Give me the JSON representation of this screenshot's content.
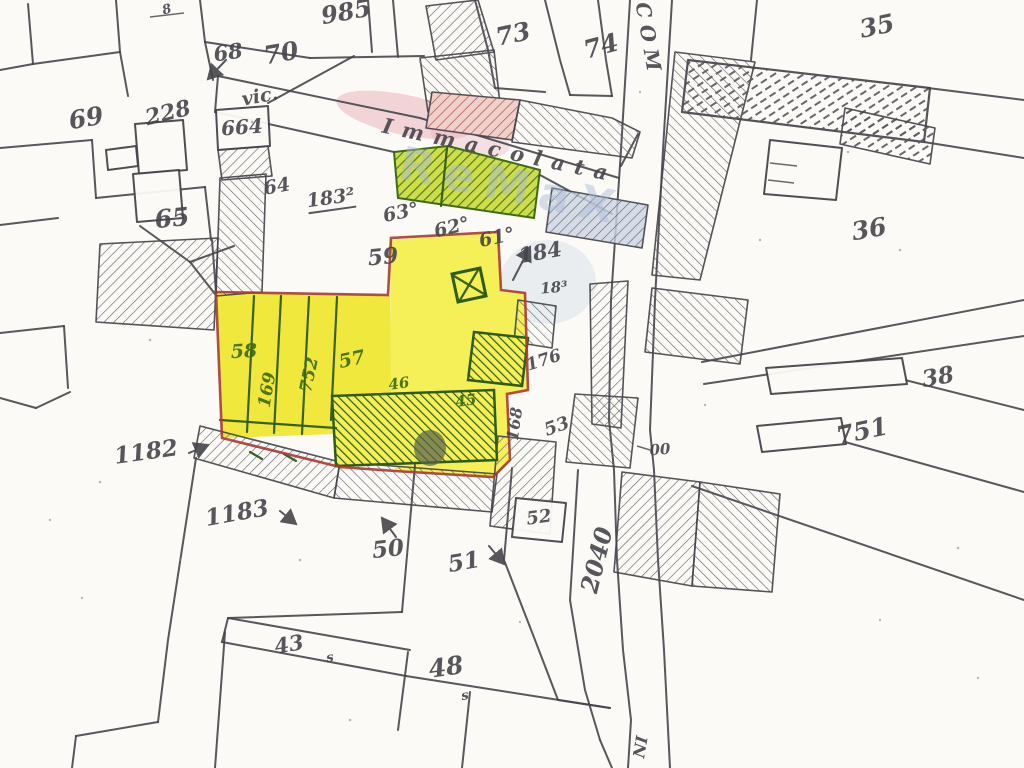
{
  "title": "Mappa catastale - vic. Immacolata",
  "colors": {
    "paper": "#fbfaf6",
    "pencil": "#45454b",
    "hatch": "#5b5b61",
    "yellow": "#f0e83c",
    "yellow_light": "#f5ef58",
    "red_outline": "#a83a36",
    "green_dark": "#2f5c17",
    "green_bright": "#4e7d1c",
    "green_bg": "#cedd49",
    "pink_bg": "#f0d0ca",
    "pink_line": "#b4625c",
    "blue_bg": "#ccd5e3",
    "label_green": "#3c6a12",
    "watermark_pink": "#e9aeb8",
    "watermark_blue": "#a9b9d8"
  },
  "watermark": {
    "text": "ReMaX"
  },
  "street": {
    "prefix": "vic.",
    "name": "Immacolata",
    "road_label": "COM",
    "road_label_bottom": "NI"
  },
  "labels": [
    {
      "text": "985",
      "x": 346,
      "y": 12,
      "rot": -10,
      "size": 24
    },
    {
      "text": "8",
      "x": 167,
      "y": 10,
      "rot": -15,
      "size": 13
    },
    {
      "text": "68",
      "x": 228,
      "y": 52,
      "rot": -8,
      "size": 21
    },
    {
      "text": "70",
      "x": 281,
      "y": 53,
      "rot": -10,
      "size": 25
    },
    {
      "text": "73",
      "x": 513,
      "y": 34,
      "rot": -12,
      "size": 25
    },
    {
      "text": "74",
      "x": 601,
      "y": 46,
      "rot": -15,
      "size": 25
    },
    {
      "text": "COM",
      "x": 649,
      "y": 40,
      "rot": 80,
      "size": 20,
      "sp": 7
    },
    {
      "text": "35",
      "x": 877,
      "y": 26,
      "rot": -12,
      "size": 25
    },
    {
      "text": "69",
      "x": 86,
      "y": 118,
      "rot": -10,
      "size": 25
    },
    {
      "text": "228",
      "x": 168,
      "y": 113,
      "rot": -14,
      "size": 22
    },
    {
      "text": "664",
      "x": 242,
      "y": 127,
      "rot": -4,
      "size": 20
    },
    {
      "text": "vic.",
      "x": 260,
      "y": 97,
      "rot": -10,
      "size": 19
    },
    {
      "text": "Immacolata",
      "x": 500,
      "y": 150,
      "rot": 12,
      "size": 21,
      "sp": 10
    },
    {
      "text": "65",
      "x": 172,
      "y": 218,
      "rot": -6,
      "size": 25
    },
    {
      "text": "64",
      "x": 277,
      "y": 187,
      "rot": -10,
      "size": 19
    },
    {
      "text": "183²",
      "x": 331,
      "y": 200,
      "rot": -8,
      "size": 19,
      "u": true
    },
    {
      "text": "63°",
      "x": 401,
      "y": 213,
      "rot": -12,
      "size": 19
    },
    {
      "text": "62°",
      "x": 452,
      "y": 228,
      "rot": -14,
      "size": 19
    },
    {
      "text": "61°",
      "x": 497,
      "y": 238,
      "rot": -12,
      "size": 19
    },
    {
      "text": "184",
      "x": 540,
      "y": 252,
      "rot": -10,
      "size": 21
    },
    {
      "text": "18³",
      "x": 554,
      "y": 288,
      "rot": -5,
      "size": 15
    },
    {
      "text": "36",
      "x": 869,
      "y": 229,
      "rot": -10,
      "size": 25
    },
    {
      "text": "59",
      "x": 383,
      "y": 257,
      "rot": -6,
      "size": 22
    },
    {
      "text": "58",
      "x": 244,
      "y": 352,
      "rot": -3,
      "size": 19,
      "g": true
    },
    {
      "text": "169",
      "x": 268,
      "y": 390,
      "rot": -80,
      "size": 17,
      "g": true
    },
    {
      "text": "752",
      "x": 310,
      "y": 375,
      "rot": -78,
      "size": 17,
      "g": true
    },
    {
      "text": "57",
      "x": 352,
      "y": 360,
      "rot": -12,
      "size": 19,
      "g": true
    },
    {
      "text": "46",
      "x": 399,
      "y": 384,
      "rot": -8,
      "size": 15,
      "g": true
    },
    {
      "text": "45",
      "x": 466,
      "y": 401,
      "rot": -8,
      "size": 15,
      "g": true
    },
    {
      "text": "176",
      "x": 544,
      "y": 361,
      "rot": -18,
      "size": 17
    },
    {
      "text": "168",
      "x": 515,
      "y": 424,
      "rot": -82,
      "size": 16
    },
    {
      "text": "53",
      "x": 557,
      "y": 427,
      "rot": -20,
      "size": 18
    },
    {
      "text": "52",
      "x": 539,
      "y": 518,
      "rot": -8,
      "size": 18
    },
    {
      "text": "00",
      "x": 660,
      "y": 450,
      "rot": -5,
      "size": 15
    },
    {
      "text": "38",
      "x": 938,
      "y": 377,
      "rot": -10,
      "size": 23
    },
    {
      "text": "751",
      "x": 862,
      "y": 431,
      "rot": -12,
      "size": 25
    },
    {
      "text": "1182",
      "x": 146,
      "y": 452,
      "rot": -8,
      "size": 23
    },
    {
      "text": "1183",
      "x": 237,
      "y": 513,
      "rot": -10,
      "size": 23
    },
    {
      "text": "50",
      "x": 388,
      "y": 549,
      "rot": -6,
      "size": 23
    },
    {
      "text": "51",
      "x": 464,
      "y": 562,
      "rot": -10,
      "size": 23
    },
    {
      "text": "2040",
      "x": 597,
      "y": 560,
      "rot": -76,
      "size": 24
    },
    {
      "text": "43",
      "x": 289,
      "y": 644,
      "rot": -10,
      "size": 21
    },
    {
      "text": "48",
      "x": 446,
      "y": 667,
      "rot": -8,
      "size": 25
    },
    {
      "text": "NI",
      "x": 641,
      "y": 747,
      "rot": -80,
      "size": 16
    },
    {
      "text": "s",
      "x": 330,
      "y": 658,
      "rot": -10,
      "size": 13
    },
    {
      "text": "s",
      "x": 465,
      "y": 696,
      "rot": -10,
      "size": 13
    }
  ]
}
